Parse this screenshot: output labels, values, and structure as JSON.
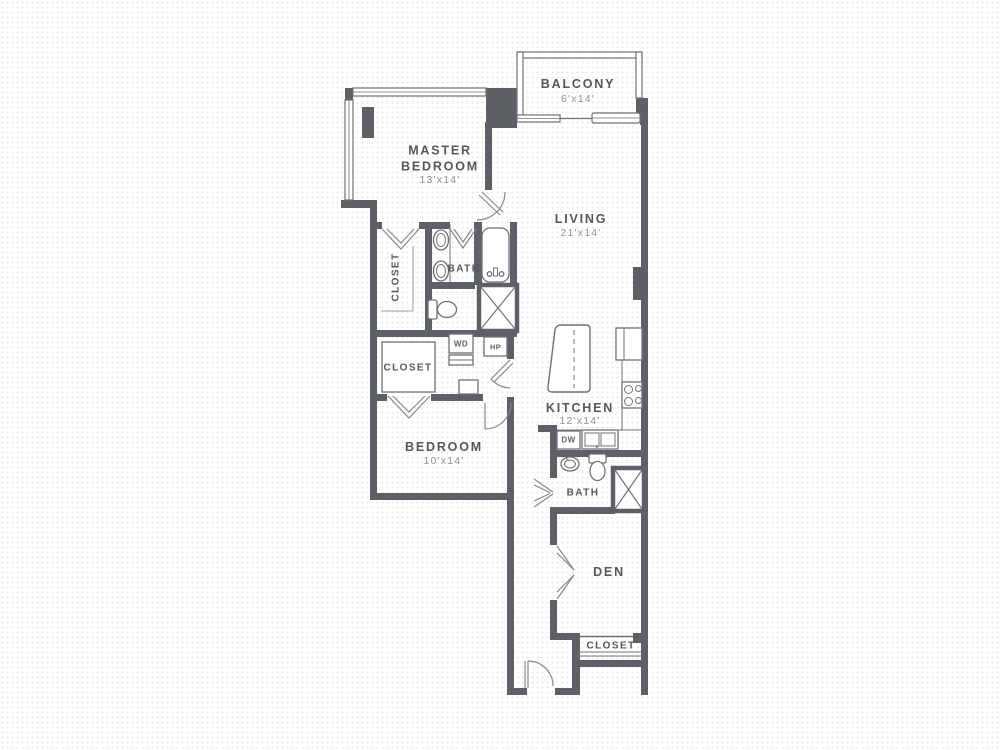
{
  "plan": {
    "rooms": {
      "balcony": {
        "label": "BALCONY",
        "dims": "6'x14'"
      },
      "master_bedroom": {
        "label": "MASTER BEDROOM",
        "dims": "13'x14'"
      },
      "living": {
        "label": "LIVING",
        "dims": "21'x14'"
      },
      "master_closet": {
        "label": "CLOSET"
      },
      "master_bath": {
        "label": "BATH"
      },
      "bedroom_closet": {
        "label": "CLOSET"
      },
      "kitchen": {
        "label": "KITCHEN",
        "dims": "12'x14'"
      },
      "bedroom": {
        "label": "BEDROOM",
        "dims": "10'x14'"
      },
      "bath2": {
        "label": "BATH"
      },
      "den": {
        "label": "DEN"
      },
      "den_closet": {
        "label": "CLOSET"
      }
    },
    "appliances": {
      "washer_dryer": "WD",
      "heat_pump": "HP",
      "dishwasher": "DW"
    },
    "colors": {
      "wall": "#5d6165",
      "thin_line": "#6e7276",
      "label_text": "#54585c",
      "dims_text": "#8f9296",
      "background": "#ffffff"
    }
  }
}
